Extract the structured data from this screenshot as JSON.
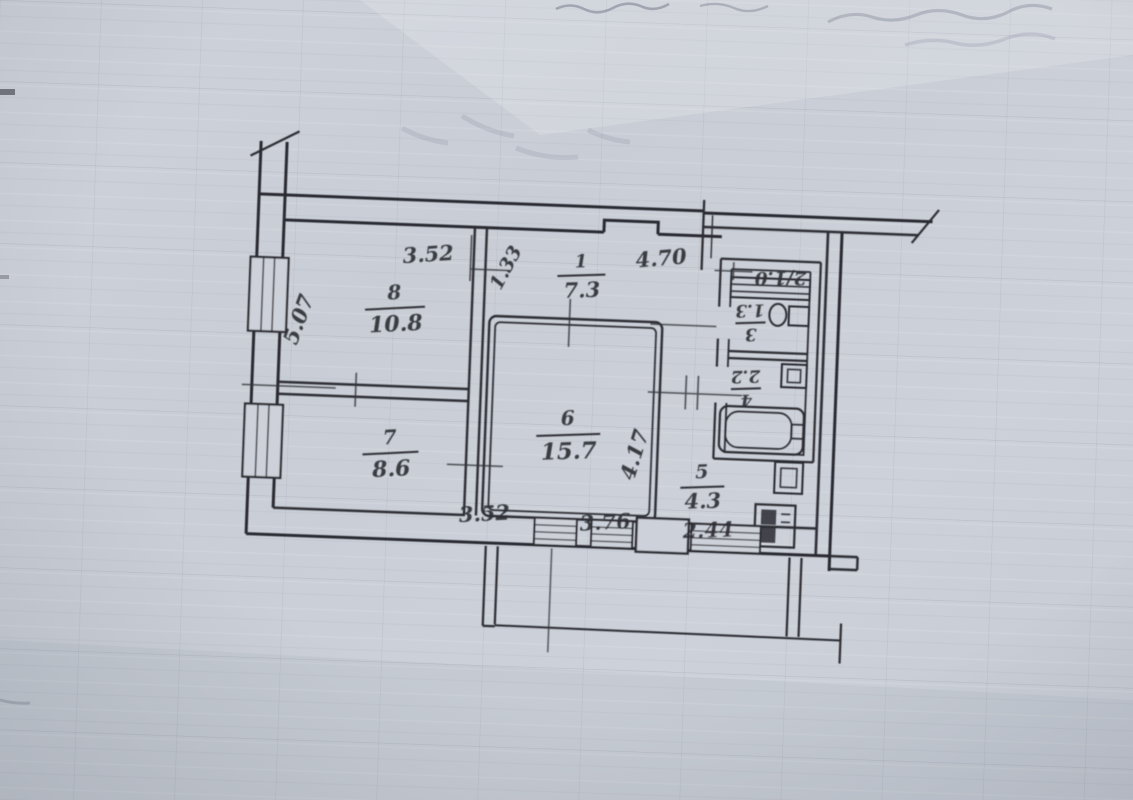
{
  "document": {
    "kind": "scanned apartment floor plan on squared paper"
  },
  "colors": {
    "paper": "#cbd0d8",
    "paper_light": "#d6dae0",
    "ink": "#2b2c33"
  },
  "plan": {
    "rooms": [
      {
        "number": "1",
        "area": "7.3"
      },
      {
        "number": "2",
        "area": "1.0",
        "label": "2/1.0"
      },
      {
        "number": "3",
        "area": "1.3"
      },
      {
        "number": "4",
        "area": "2.2"
      },
      {
        "number": "5",
        "area": "4.3"
      },
      {
        "number": "6",
        "area": "15.7"
      },
      {
        "number": "7",
        "area": "8.6"
      },
      {
        "number": "8",
        "area": "10.8"
      }
    ],
    "dimensions": {
      "room8_top_width": "3.52",
      "hall_left_offset": "1.33",
      "hall_top_width": "4.70",
      "left_side_height": "5.07",
      "room6_right_height": "4.17",
      "room7_bottom_width": "3.52",
      "room6_bottom_width": "3.76",
      "room5_bottom_width": "2.44"
    }
  }
}
